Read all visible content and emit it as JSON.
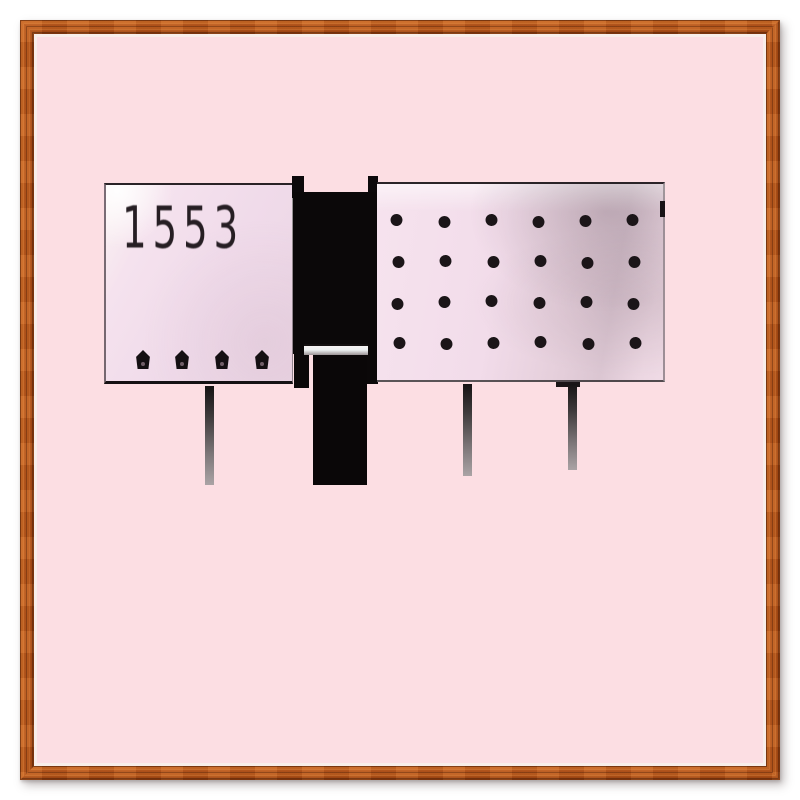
{
  "frame": {
    "material": "wood",
    "wood_color": "#b5541b",
    "liner_color": "#f8eeea",
    "matte_color": "#fcdee3"
  },
  "artwork": {
    "house_number": "1553",
    "panel_color": "#f0dbea",
    "ink_color": "#120e10",
    "left_panel": {
      "knob_count": 4
    },
    "right_panel": {
      "dot_rows": 4,
      "dot_cols": 6
    },
    "leg_count": 4
  }
}
